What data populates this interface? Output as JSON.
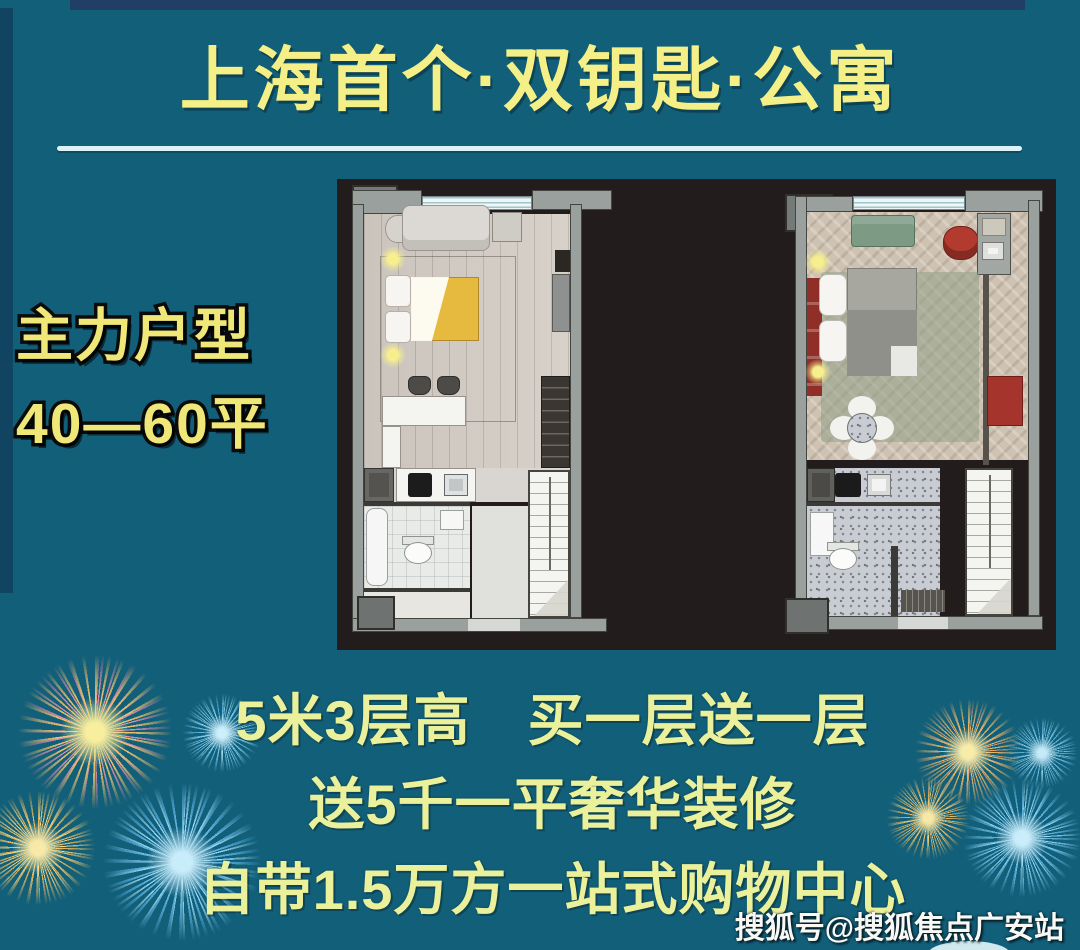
{
  "poster": {
    "title": "上海首个·双钥匙·公寓",
    "unit_type_line1": "主力户型",
    "unit_type_line2": "40—60平",
    "selling_points": [
      "5米3层高　买一层送一层",
      "送5千一平奢华装修",
      "自带1.5万方一站式购物中心"
    ],
    "watermark": "搜狐号@搜狐焦点广安站",
    "floor_plans": {
      "count": 2,
      "left_description": "loft unit plan: bedroom with bed and sofa, kitchen counter, tiled bathroom, staircase",
      "right_description": "loft unit plan: bedroom with bed, green sofa, red armchairs, flower table, terrazzo bathroom, staircase"
    }
  },
  "colors": {
    "background_teal": "#125f79",
    "headline_yellow": "#f4f087",
    "unit_text_yellow": "#efe878",
    "selling_text_yellow": "#ebf09b",
    "underline_cyan": "#dcf2f6",
    "panel_dark": "#221c1d",
    "watermark_white": "#f8f8f5"
  }
}
